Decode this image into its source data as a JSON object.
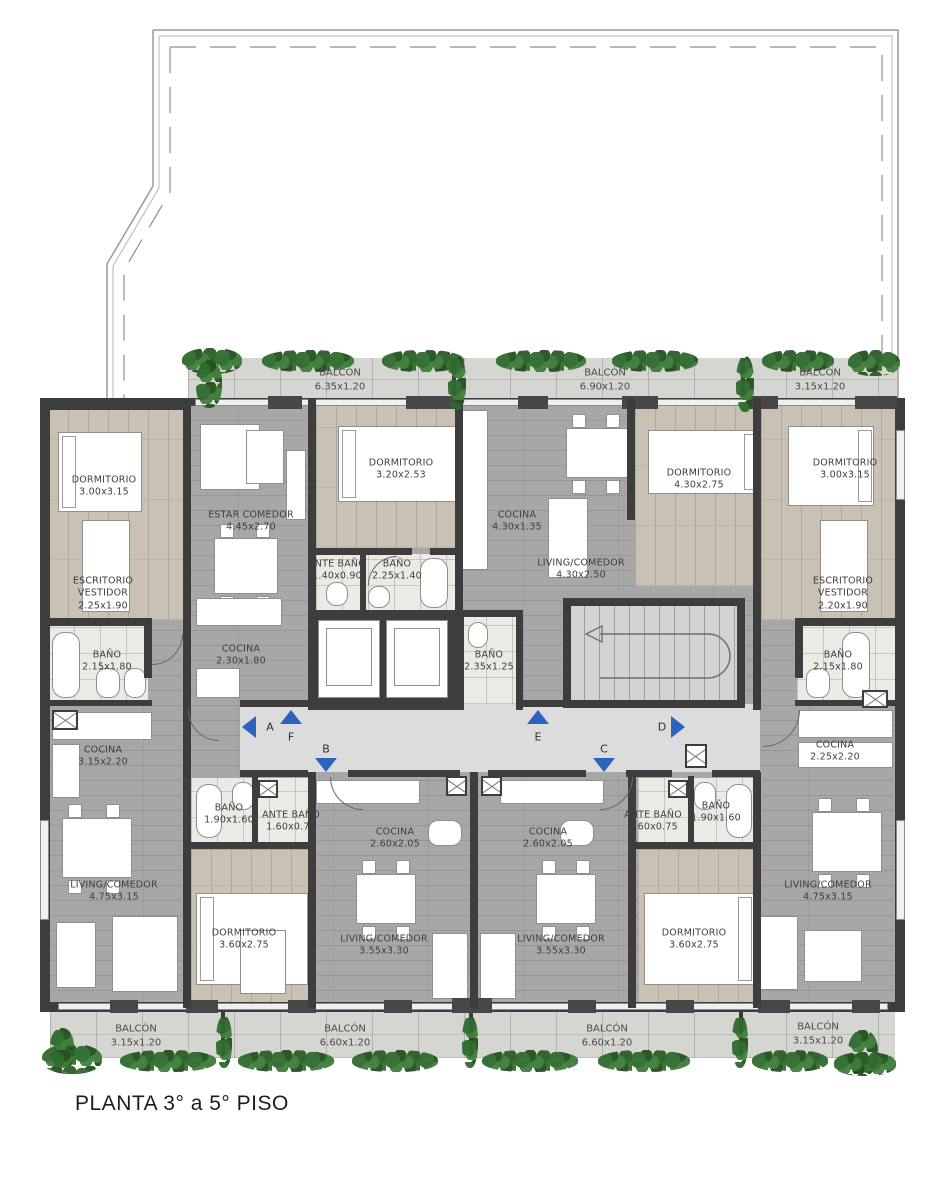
{
  "title": "PLANTA 3° a 5° PISO",
  "plan": {
    "balconies_top": [
      {
        "label": "BALCÓN",
        "dims": "6.35x1.20"
      },
      {
        "label": "BALCÓN",
        "dims": "6.90x1.20"
      },
      {
        "label": "BALCÓN",
        "dims": "3.15x1.20"
      }
    ],
    "balconies_bottom": [
      {
        "label": "BALCÓN",
        "dims": "3.15x1.20"
      },
      {
        "label": "BALCÓN",
        "dims": "6.60x1.20"
      },
      {
        "label": "BALCÓN",
        "dims": "6.60x1.20"
      },
      {
        "label": "BALCÓN",
        "dims": "3.15x1.20"
      }
    ],
    "rooms": [
      {
        "name": "DORMITORIO",
        "dims": "3.00x3.15"
      },
      {
        "name": "ESTAR  COMEDOR",
        "dims": "4.45x2.70"
      },
      {
        "name": "DORMITORIO",
        "dims": "3.20x2.53"
      },
      {
        "name": "COCINA",
        "dims": "4.30x1.35"
      },
      {
        "name": "LIVING/COMEDOR",
        "dims": "4.30x2.50"
      },
      {
        "name": "DORMITORIO",
        "dims": "4.30x2.75"
      },
      {
        "name": "DORMITORIO",
        "dims": "3.00x3.15"
      },
      {
        "name": "ESCRITORIO",
        "sub": "VESTIDOR",
        "dims": "2.25x1.90"
      },
      {
        "name": "ESCRITORIO",
        "sub": "VESTIDOR",
        "dims": "2.20x1.90"
      },
      {
        "name": "ANTE  BAÑO",
        "dims": "1.40x0.90"
      },
      {
        "name": "BAÑO",
        "dims": "2.25x1.40"
      },
      {
        "name": "BAÑO",
        "dims": "2.15x1.80"
      },
      {
        "name": "COCINA",
        "dims": "2.30x1.80"
      },
      {
        "name": "BAÑO",
        "dims": "2.35x1.25"
      },
      {
        "name": "BAÑO",
        "dims": "2.15x1.80"
      },
      {
        "name": "COCINA",
        "dims": "3.15x2.20"
      },
      {
        "name": "COCINA",
        "dims": "2.25x2.20"
      },
      {
        "name": "BAÑO",
        "dims": "1.90x1.60"
      },
      {
        "name": "ANTE  BAÑO",
        "dims": "1.60x0.75"
      },
      {
        "name": "ANTE  BAÑO",
        "dims": "1.60x0.75"
      },
      {
        "name": "BAÑO",
        "dims": "1.90x1.60"
      },
      {
        "name": "COCINA",
        "dims": "2.60x2.05"
      },
      {
        "name": "COCINA",
        "dims": "2.60x2.05"
      },
      {
        "name": "LIVING/COMEDOR",
        "dims": "4.75x3.15"
      },
      {
        "name": "LIVING/COMEDOR",
        "dims": "4.75x3.15"
      },
      {
        "name": "DORMITORIO",
        "dims": "3.60x2.75"
      },
      {
        "name": "DORMITORIO",
        "dims": "3.60x2.75"
      },
      {
        "name": "LIVING/COMEDOR",
        "dims": "3.55x3.30"
      },
      {
        "name": "LIVING/COMEDOR",
        "dims": "3.55x3.30"
      }
    ],
    "corridor_markers": [
      {
        "label": "A",
        "dir": "left"
      },
      {
        "label": "F",
        "dir": "up"
      },
      {
        "label": "B",
        "dir": "down"
      },
      {
        "label": "E",
        "dir": "up"
      },
      {
        "label": "C",
        "dir": "down"
      },
      {
        "label": "D",
        "dir": "right"
      }
    ],
    "colors": {
      "arrow": "#2d62bd",
      "wall": "#3d3d3d",
      "wood_floor": "#c9c1b4",
      "gray_floor": "#a7a7a7",
      "balcony_floor": "#d5d5d1",
      "plant_green": "#2f6b2e"
    }
  }
}
